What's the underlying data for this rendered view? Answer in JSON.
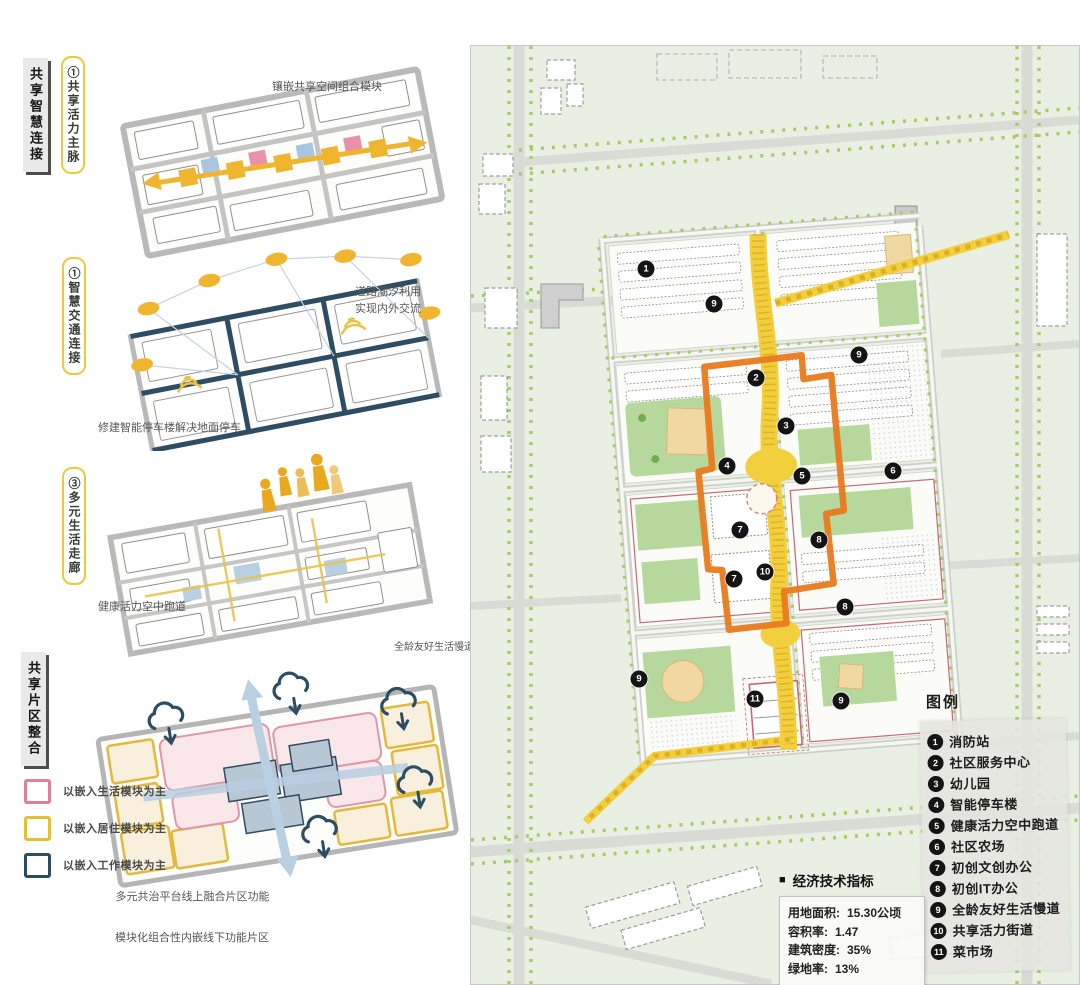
{
  "left": {
    "section_tabs": [
      {
        "label": "共享智慧连接"
      },
      {
        "label": "共享片区整合"
      }
    ],
    "callouts": [
      {
        "text": "①共享活力主脉"
      },
      {
        "text": "①智慧交通连接"
      },
      {
        "text": "③多元生活走廊"
      }
    ],
    "annotations": {
      "module_band": "镶嵌共享空间组合模块",
      "tidal_road": "道路潮汐利用\n实现内外交流",
      "parking": "修建智能停车楼解决地面停车",
      "sky_track": "健康活力空中跑道",
      "slow_lane": "全龄友好生活慢道",
      "online_platform": "多元共治平台线上融合片区功能",
      "offline_modules": "模块化组合性内嵌线下功能片区"
    },
    "module_legend": [
      {
        "color": "#dd8093",
        "label": "以嵌入生活模块为主"
      },
      {
        "color": "#e6bf3a",
        "label": "以嵌入居住模块为主"
      },
      {
        "color": "#2e4d63",
        "label": "以嵌入工作模块为主"
      }
    ]
  },
  "map": {
    "legend_title": "图例",
    "legend_items": [
      {
        "num": "1",
        "label": "消防站"
      },
      {
        "num": "2",
        "label": "社区服务中心"
      },
      {
        "num": "3",
        "label": "幼儿园"
      },
      {
        "num": "4",
        "label": "智能停车楼"
      },
      {
        "num": "5",
        "label": "健康活力空中跑道"
      },
      {
        "num": "6",
        "label": "社区农场"
      },
      {
        "num": "7",
        "label": "初创文创办公"
      },
      {
        "num": "8",
        "label": "初创IT办公"
      },
      {
        "num": "9",
        "label": "全龄友好生活慢道"
      },
      {
        "num": "10",
        "label": "共享活力街道"
      },
      {
        "num": "11",
        "label": "菜市场"
      }
    ],
    "markers": [
      {
        "num": "1",
        "x": 175,
        "y": 223
      },
      {
        "num": "9",
        "x": 243,
        "y": 258
      },
      {
        "num": "9",
        "x": 388,
        "y": 309
      },
      {
        "num": "2",
        "x": 285,
        "y": 332
      },
      {
        "num": "3",
        "x": 315,
        "y": 380
      },
      {
        "num": "4",
        "x": 256,
        "y": 420
      },
      {
        "num": "5",
        "x": 331,
        "y": 430
      },
      {
        "num": "6",
        "x": 422,
        "y": 425
      },
      {
        "num": "7",
        "x": 269,
        "y": 484
      },
      {
        "num": "8",
        "x": 348,
        "y": 494
      },
      {
        "num": "10",
        "x": 294,
        "y": 526
      },
      {
        "num": "7",
        "x": 263,
        "y": 533
      },
      {
        "num": "8",
        "x": 374,
        "y": 561
      },
      {
        "num": "9",
        "x": 168,
        "y": 633
      },
      {
        "num": "11",
        "x": 284,
        "y": 653
      },
      {
        "num": "9",
        "x": 370,
        "y": 655
      }
    ],
    "indicators": {
      "bullet": "■",
      "title": "经济技术指标",
      "rows": [
        {
          "label": "用地面积:",
          "value": "15.30公顷"
        },
        {
          "label": "容积率:",
          "value": "1.47"
        },
        {
          "label": "建筑密度:",
          "value": "35%"
        },
        {
          "label": "绿地率:",
          "value": "13%"
        }
      ]
    },
    "colors": {
      "vitality_street_orange": "#e87a1e",
      "axis_yellow": "#f2cf3d",
      "marker_black": "#141414",
      "courtyard_green": "#b7d89c",
      "background_green": "#e9f0e3"
    }
  }
}
